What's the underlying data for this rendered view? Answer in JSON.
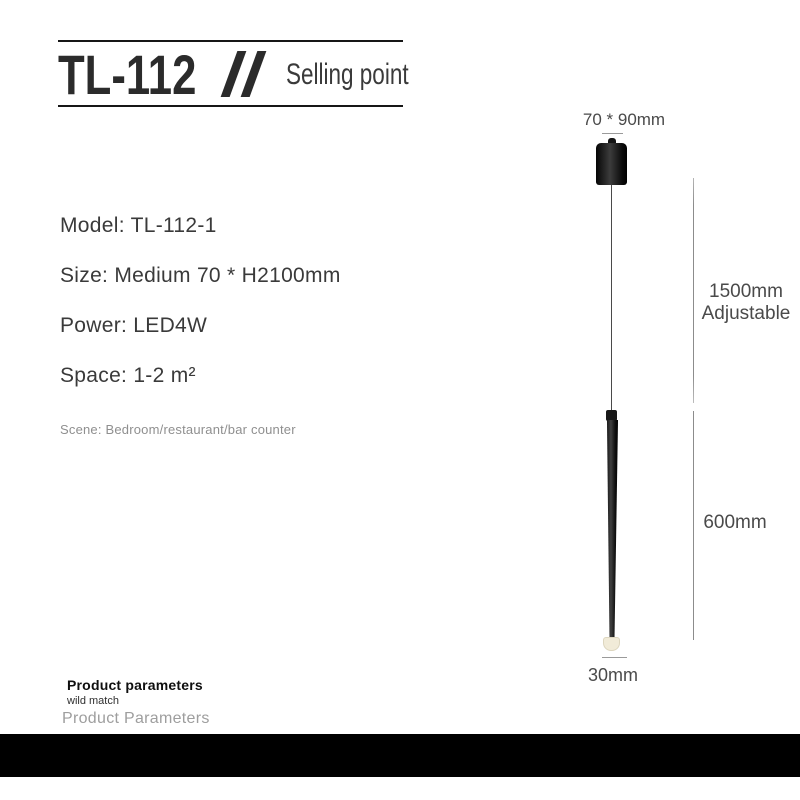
{
  "header": {
    "model_code": "TL-112",
    "subtitle": "Selling point"
  },
  "specs": {
    "items": [
      "Model: TL-112-1",
      "Size: Medium 70 * H2100mm",
      "Power: LED4W",
      "Space: 1-2 m²"
    ],
    "scene_note": "Scene: Bedroom/restaurant/bar counter"
  },
  "diagram": {
    "top_dimension": "70 * 90mm",
    "drop_dimension_line1": "1500mm",
    "drop_dimension_line2": "Adjustable",
    "tube_dimension": "600mm",
    "bottom_dimension": "30mm",
    "colors": {
      "fixture_black": "#141414",
      "led_tip": "#f1ebd8",
      "dimension_line": "#8c8c8c",
      "dimension_text": "#4a4a4a"
    }
  },
  "footer": {
    "title": "Product parameters",
    "subtitle": "wild match",
    "caption": "Product Parameters",
    "bar_color": "#000000"
  }
}
